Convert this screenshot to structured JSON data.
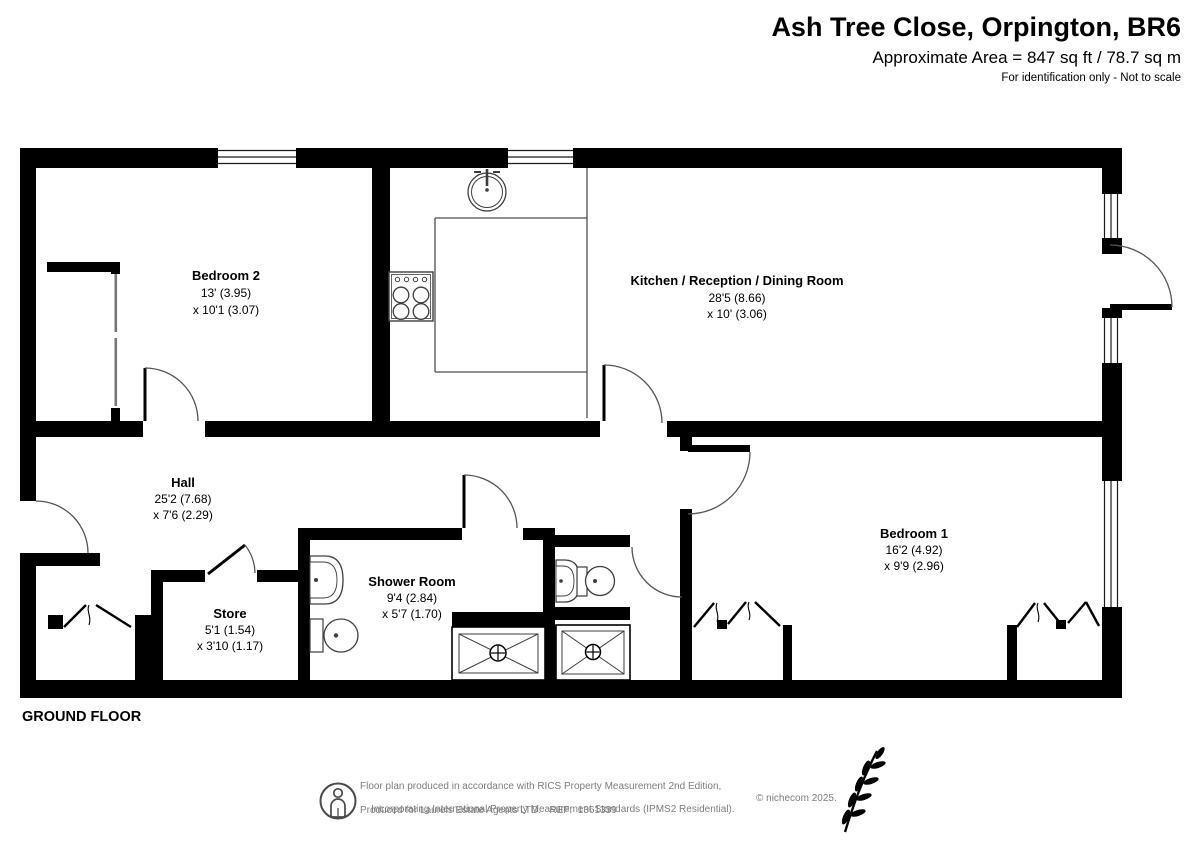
{
  "header": {
    "title": "Ash Tree Close, Orpington, BR6",
    "area_line": "Approximate Area = 847 sq ft / 78.7 sq m",
    "disclaimer": "For identification only - Not to scale"
  },
  "floor_label": "GROUND FLOOR",
  "rooms": {
    "bedroom2": {
      "name": "Bedroom 2",
      "dim1": "13' (3.95)",
      "dim2": "x 10'1 (3.07)"
    },
    "kitchen": {
      "name": "Kitchen / Reception / Dining Room",
      "dim1": "28'5 (8.66)",
      "dim2": "x 10' (3.06)"
    },
    "hall": {
      "name": "Hall",
      "dim1": "25'2 (7.68)",
      "dim2": "x 7'6 (2.29)"
    },
    "store": {
      "name": "Store",
      "dim1": "5'1 (1.54)",
      "dim2": "x 3'10 (1.17)"
    },
    "shower_room": {
      "name": "Shower Room",
      "dim1": "9'4 (2.84)",
      "dim2": "x 5'7 (1.70)"
    },
    "bedroom1": {
      "name": "Bedroom 1",
      "dim1": "16'2 (4.92)",
      "dim2": "x 9'9 (2.96)"
    }
  },
  "footer": {
    "line1": "Floor plan produced in accordance with RICS Property Measurement 2nd Edition,",
    "line2": "Incorporating International Property Measurement Standards (IPMS2 Residential).",
    "copyright": "© nichecom 2025.",
    "line3": "Produced for Laurels Estate Agents LTD.   REF:  1361339"
  },
  "icons": {
    "measurement": "person-in-circle-icon",
    "brand": "leaf-branch-icon"
  },
  "colors": {
    "wall": "#000000",
    "fixture_line": "#3d3d3d",
    "door_arc": "#555555",
    "muted_text": "#7d7d7d"
  }
}
